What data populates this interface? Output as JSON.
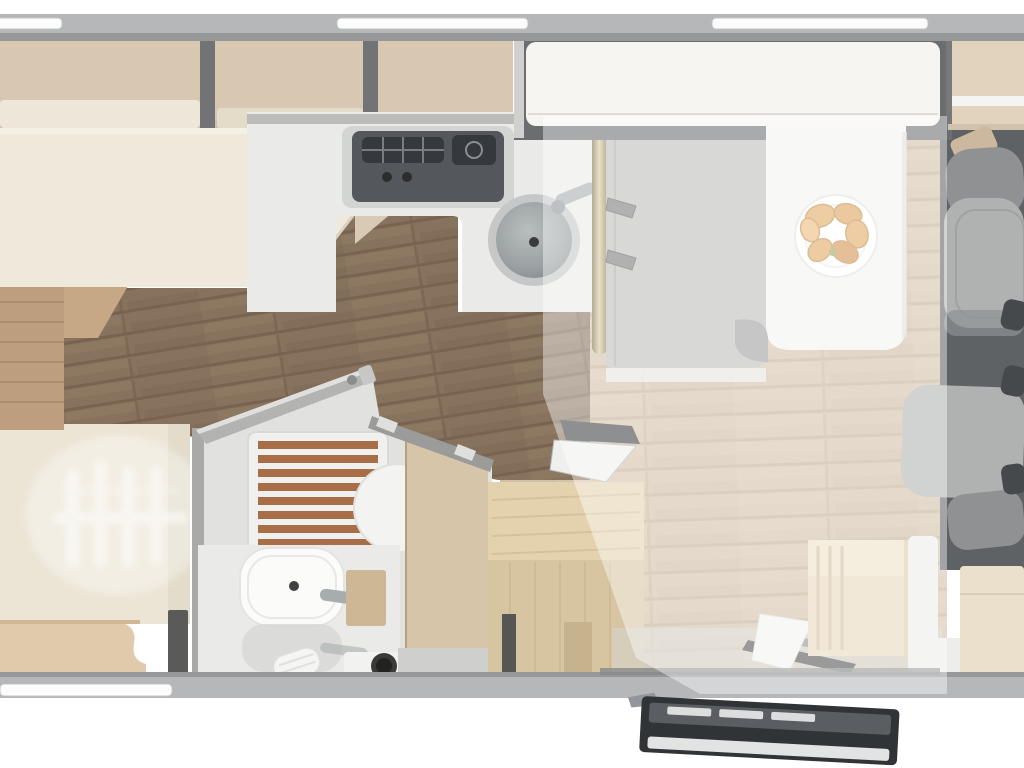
{
  "scene": {
    "description": "Top-down 3D rendered floor plan of a motorhome interior",
    "highlight_overlay": {
      "area": "lounge-dinette-and-entry-zone",
      "color": "#ffffff",
      "opacity": 0.42
    }
  },
  "colors": {
    "page_bg": "#ffffff",
    "wall": "#b6b7b9",
    "wall_edge": "#97989a",
    "window": "#fcfcfc",
    "locker_tan": "#d8c8b1",
    "locker_front": "#eee7d9",
    "divider": "#717375",
    "bed_cream": "#efe9db",
    "bed_side": "#d8cab4",
    "strip_tan": "#bd9f7f",
    "strip_tan_line": "#a9896a",
    "garage_cream": "#ece5d6",
    "garage_tan": "#e1caac",
    "corner_dark": "#5a5a58",
    "floor_light": "#d0bea6",
    "floor_light_line": "#c2ad92",
    "floor_dark": "#87735d",
    "floor_dark_line": "#776350",
    "cab_floor": "#5f6265",
    "counter": "#eaebe9",
    "counter_rail": "#b3b4b2",
    "hob_base": "#d3d5d3",
    "hob": "#54585c",
    "hob_grate": "#35383c",
    "sink_ring": "#c5c8c7",
    "sink_bowl": "#9ba1a2",
    "metal": "#a7adad",
    "brass": "#c0a87e",
    "brass_dark": "#7d6c49",
    "mattress": "#bcbdba",
    "mattress_edge": "#a3a4a1",
    "frame": "#6b6d6f",
    "frame_light": "#d0d1cf",
    "panel_white": "#f6f5f2",
    "table": "#f3f3f1",
    "plate": "#ffffff",
    "plate_rim": "#e2e2e0",
    "croissant": "#e2a964",
    "croissant_dark": "#c18c49",
    "bath_wall": "#a9a9a7",
    "bath_floor": "#e1e1df",
    "bath_base": "#eaeae8",
    "slat": "#a76e47",
    "slat_gap": "#f0f0ee",
    "door_diag": "#b3b3b1",
    "hinge_metal": "#dfdfdd",
    "beige_panel": "#d7c5aa",
    "basin": "#fbfbf9",
    "basin_rim": "#e4e4e2",
    "reflection": "#d8d8d6",
    "tan_box": "#cdb795",
    "towel": "#f5f5f3",
    "hole_dark": "#222220",
    "wardrobe_top": "#e4d2ae",
    "wardrobe_front": "#d7c4a0",
    "wardrobe_dark": "#c6b28c",
    "hatch_dark": "#3c3e40",
    "hatch_white": "#eff0ee",
    "steps_wood": "#e7d8ba",
    "steps_line": "#cdbc9c",
    "lpanel": "#ededeb",
    "cream_cab": "#ebe0cc",
    "cab_beige": "#e2d3bf",
    "belt_tan": "#cbb89e",
    "seat_light": "#b0b2b1",
    "seat_mid": "#8f9193",
    "seat_dark": "#7c7e80",
    "armrest": "#46494b",
    "door_body": "#313437",
    "door_inner": "#5a5d61",
    "door_slat": "#e8e9e9",
    "door_sill": "#e2e3e3",
    "overlay": "#ffffff",
    "wedge_gray": "#9b9d9c",
    "well": "#d6d6d2",
    "well_dark": "#3a3c3e",
    "mat_white": "#f3f3f1"
  },
  "furniture": {
    "rear_left": [
      "overhead-lockers",
      "rear-bed",
      "garage-with-ghost-bikes",
      "side-bench"
    ],
    "kitchen": [
      "kitchen-counter",
      "two-burner-hob",
      "round-sink",
      "sink-faucet",
      "brass-pillar"
    ],
    "bathroom": [
      "bathroom-door-open",
      "shower-wooden-grate",
      "toilet",
      "washbasin",
      "basin-faucet",
      "vanity-base",
      "towel",
      "drain-hole"
    ],
    "lounge": [
      "drop-down-bed-stowed",
      "single-bunk-mattress",
      "dinette-table",
      "plate-of-croissants",
      "wardrobe-cabinet",
      "open-hatch-lid",
      "entry-steps",
      "step-well"
    ],
    "cab": [
      "driver-seat",
      "passenger-seat",
      "overhead-shelf",
      "seatbelt-mount",
      "front-cabinets"
    ],
    "exterior": [
      "entry-door-swung-open",
      "top-wall-windows",
      "bottom-wall-window"
    ]
  }
}
